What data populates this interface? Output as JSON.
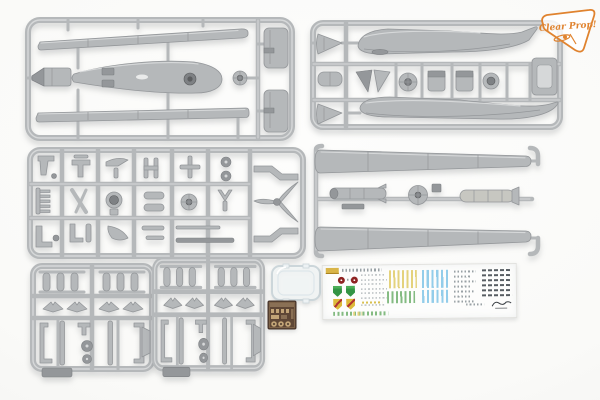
{
  "photo": {
    "description": "Contents of a plastic UAV scale-model kit: gray injection-molded sprues, two munition sprues, a clear-parts piece, a photo-etched fret and a waterslide decal sheet on a white background",
    "logo": {
      "text": "Clear Prop!"
    }
  },
  "colors": {
    "bg": "#fafaf8",
    "plastic": "#b5b8ba",
    "plastic_light": "#d6d8d9",
    "plastic_dark": "#94979a",
    "plastic_deep": "#7e8184",
    "logo_orange": "#e0832f",
    "decal_white": "#fdfdfc",
    "decal_red": "#8e2322",
    "decal_green": "#339444",
    "decal_crest_yellow": "#ddba3a",
    "decal_stripe_yellow": "#e4d27c",
    "decal_stripe_green": "#84bb82",
    "decal_stripe_blue": "#93cdea",
    "pe_base": "#5f4736",
    "pe_metal": "#c2a477",
    "clear_edge": "#ccd6da"
  },
  "components": {
    "sprue_a": "fuselage pod and long blade parts sprue",
    "sprue_b": "tail-boom fuselage halves and engine parts sprue",
    "sprue_c": "detail parts sprue with propeller and landing gear",
    "sprue_d": "wing halves and stores sprue",
    "munitions_sprue": "small munitions and pylons sprue (x2)",
    "clear_part": "clear parts piece",
    "pe_fret": "photo-etched brass fret",
    "decal_sheet": "waterslide decal sheet with emblems, stripes and stencils"
  }
}
